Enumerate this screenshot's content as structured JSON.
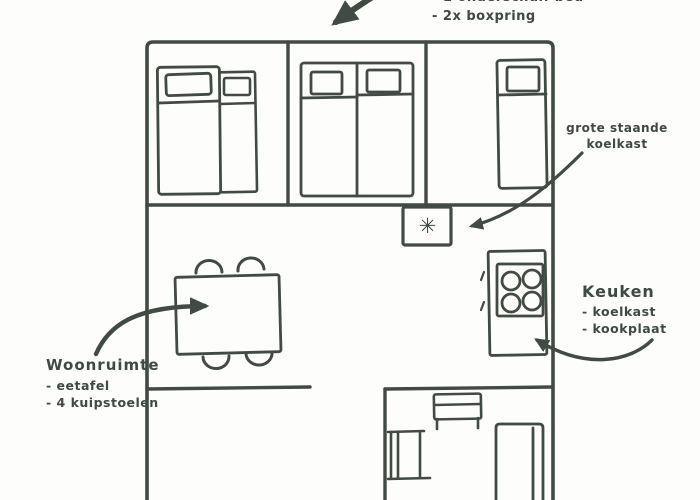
{
  "colors": {
    "ink": "#414b44",
    "paper": "#fdfdfb"
  },
  "notes": {
    "beds": {
      "lines": [
        "- 1 onderschuif bed",
        "- 2x boxpring"
      ]
    },
    "fridge": {
      "lines": [
        "grote staande",
        "koelkast"
      ]
    },
    "kitchen": {
      "title": "Keuken",
      "items": [
        "- koelkast",
        "- kookplaat"
      ]
    },
    "living": {
      "title": "Woonruimte",
      "items": [
        "- eetafel",
        "- 4 kuipstoelen"
      ]
    }
  },
  "icons": {
    "fridge_snowflake": "✳"
  }
}
